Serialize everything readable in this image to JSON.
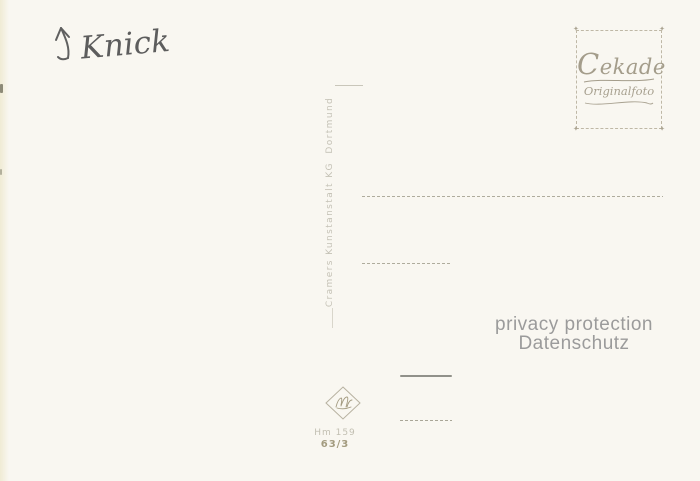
{
  "card": {
    "background": "#f9f7f1",
    "description": "blank back of a vintage photo postcard"
  },
  "annotation": {
    "text": "Knick"
  },
  "stamp": {
    "brand": "Cekade",
    "subtitle": "Originalfoto",
    "corner_glyph": "✦",
    "color": "#a8a190"
  },
  "publisher": {
    "name": "Cramers Kunstanstalt KG  Dortmund"
  },
  "watermark": {
    "line1": "privacy protection",
    "line2": "Datenschutz",
    "color": "#9b9b9b"
  },
  "print_code": {
    "series": "Hm 159",
    "number": "63/3"
  }
}
